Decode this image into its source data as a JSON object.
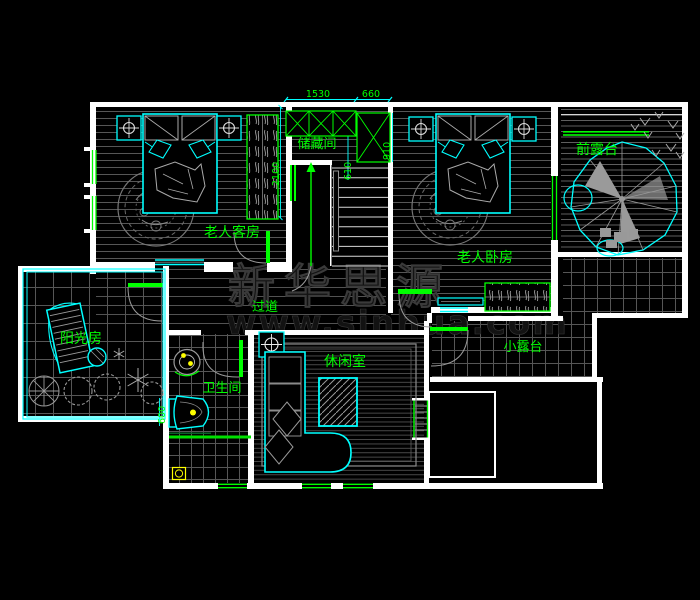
{
  "rooms": [
    {
      "id": "guest-bedroom",
      "label": "老人客房"
    },
    {
      "id": "storage",
      "label": "储藏间"
    },
    {
      "id": "master-bedroom",
      "label": "老人卧房"
    },
    {
      "id": "front-terrace",
      "label": "前露台"
    },
    {
      "id": "corridor",
      "label": "过道"
    },
    {
      "id": "sunroom",
      "label": "阳光房"
    },
    {
      "id": "bathroom",
      "label": "卫生间"
    },
    {
      "id": "lounge",
      "label": "休闲室"
    },
    {
      "id": "small-terrace",
      "label": "小露台"
    }
  ],
  "dimensions": [
    {
      "value": "1530",
      "orientation": "horizontal"
    },
    {
      "value": "660",
      "orientation": "horizontal"
    },
    {
      "value": "610",
      "orientation": "vertical"
    },
    {
      "value": "910",
      "orientation": "vertical"
    },
    {
      "value": "2100",
      "orientation": "vertical"
    },
    {
      "value": "600",
      "orientation": "vertical"
    }
  ],
  "watermark": {
    "line1": "新华思源",
    "line2": "www.sinhua.com"
  },
  "symbols": [
    "ceiling-lamp-symbol",
    "stair-direction-arrow",
    "door-swing",
    "window",
    "bed",
    "rug",
    "wardrobe",
    "sofa",
    "toilet",
    "sink",
    "tree",
    "plants"
  ],
  "colors": {
    "background": "#000000",
    "wall": "#ffffff",
    "furniture": "#00ffff",
    "label": "#00ff00",
    "floor_hatch": "#565656",
    "detail_gray": "#9a9a9a",
    "fixture_accent": "#ffff00"
  }
}
